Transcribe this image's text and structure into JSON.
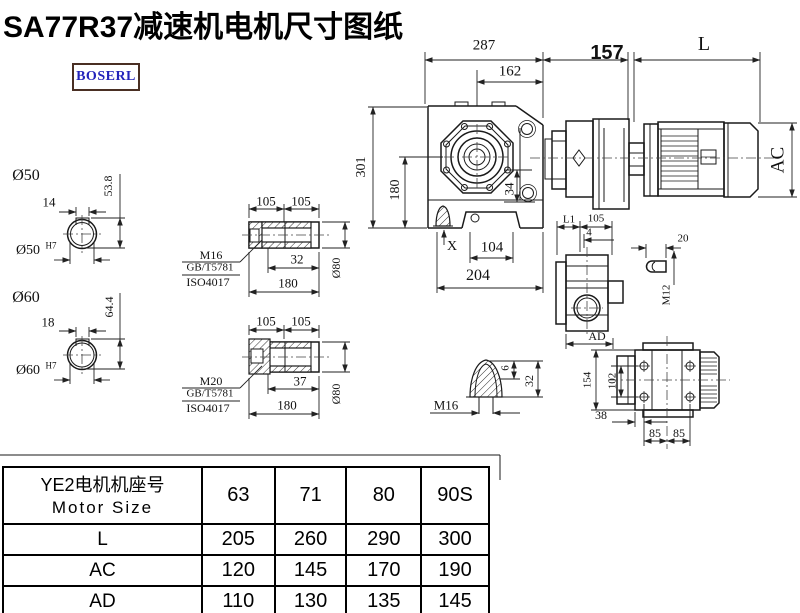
{
  "title": "SA77R37减速机电机尺寸图纸",
  "logo": {
    "text": "BOSERL"
  },
  "colors": {
    "line": "#1a1a1a",
    "logo_text": "#2323bb",
    "logo_border": "#4a2f23"
  },
  "drawing": {
    "top": {
      "d287": "287",
      "d162": "162",
      "d157": "157",
      "dL": "L",
      "dAC": "AC"
    },
    "front": {
      "d301": "301",
      "d180": "180",
      "d34": "34",
      "dX": "X",
      "d104": "104",
      "d204": "204"
    },
    "bore50": {
      "label": "Ø50",
      "key": "14",
      "height": "53.8",
      "fit": "Ø50",
      "fit_tol": "H7"
    },
    "bore60": {
      "label": "Ø60",
      "key": "18",
      "height": "64.4",
      "fit": "Ø60",
      "fit_tol": "H7"
    },
    "shaft1": {
      "d105a": "105",
      "d105b": "105",
      "thread": "M16",
      "std": "GB/T5781",
      "iso": "ISO4017",
      "depth": "32",
      "length": "180",
      "dia": "Ø80"
    },
    "shaft2": {
      "d105a": "105",
      "d105b": "105",
      "thread": "M20",
      "std": "GB/T5781",
      "iso": "ISO4017",
      "depth": "37",
      "length": "180",
      "dia": "Ø80"
    },
    "plug": {
      "d6": "6",
      "d32": "32",
      "thread": "M16"
    },
    "side": {
      "dL1": "L1",
      "d105": "105",
      "d4": "4",
      "dAD": "AD",
      "d20": "20",
      "thread": "M12"
    },
    "topview": {
      "d154": "154",
      "d102": "102",
      "d38": "38",
      "d85a": "85",
      "d85b": "85"
    }
  },
  "table": {
    "header_cn": "YE2电机机座号",
    "header_en": "Motor Size",
    "sizes": [
      "63",
      "71",
      "80",
      "90S"
    ],
    "rows": [
      {
        "label": "L",
        "values": [
          "205",
          "260",
          "290",
          "300"
        ]
      },
      {
        "label": "AC",
        "values": [
          "120",
          "145",
          "170",
          "190"
        ]
      },
      {
        "label": "AD",
        "values": [
          "110",
          "130",
          "135",
          "145"
        ]
      }
    ]
  }
}
